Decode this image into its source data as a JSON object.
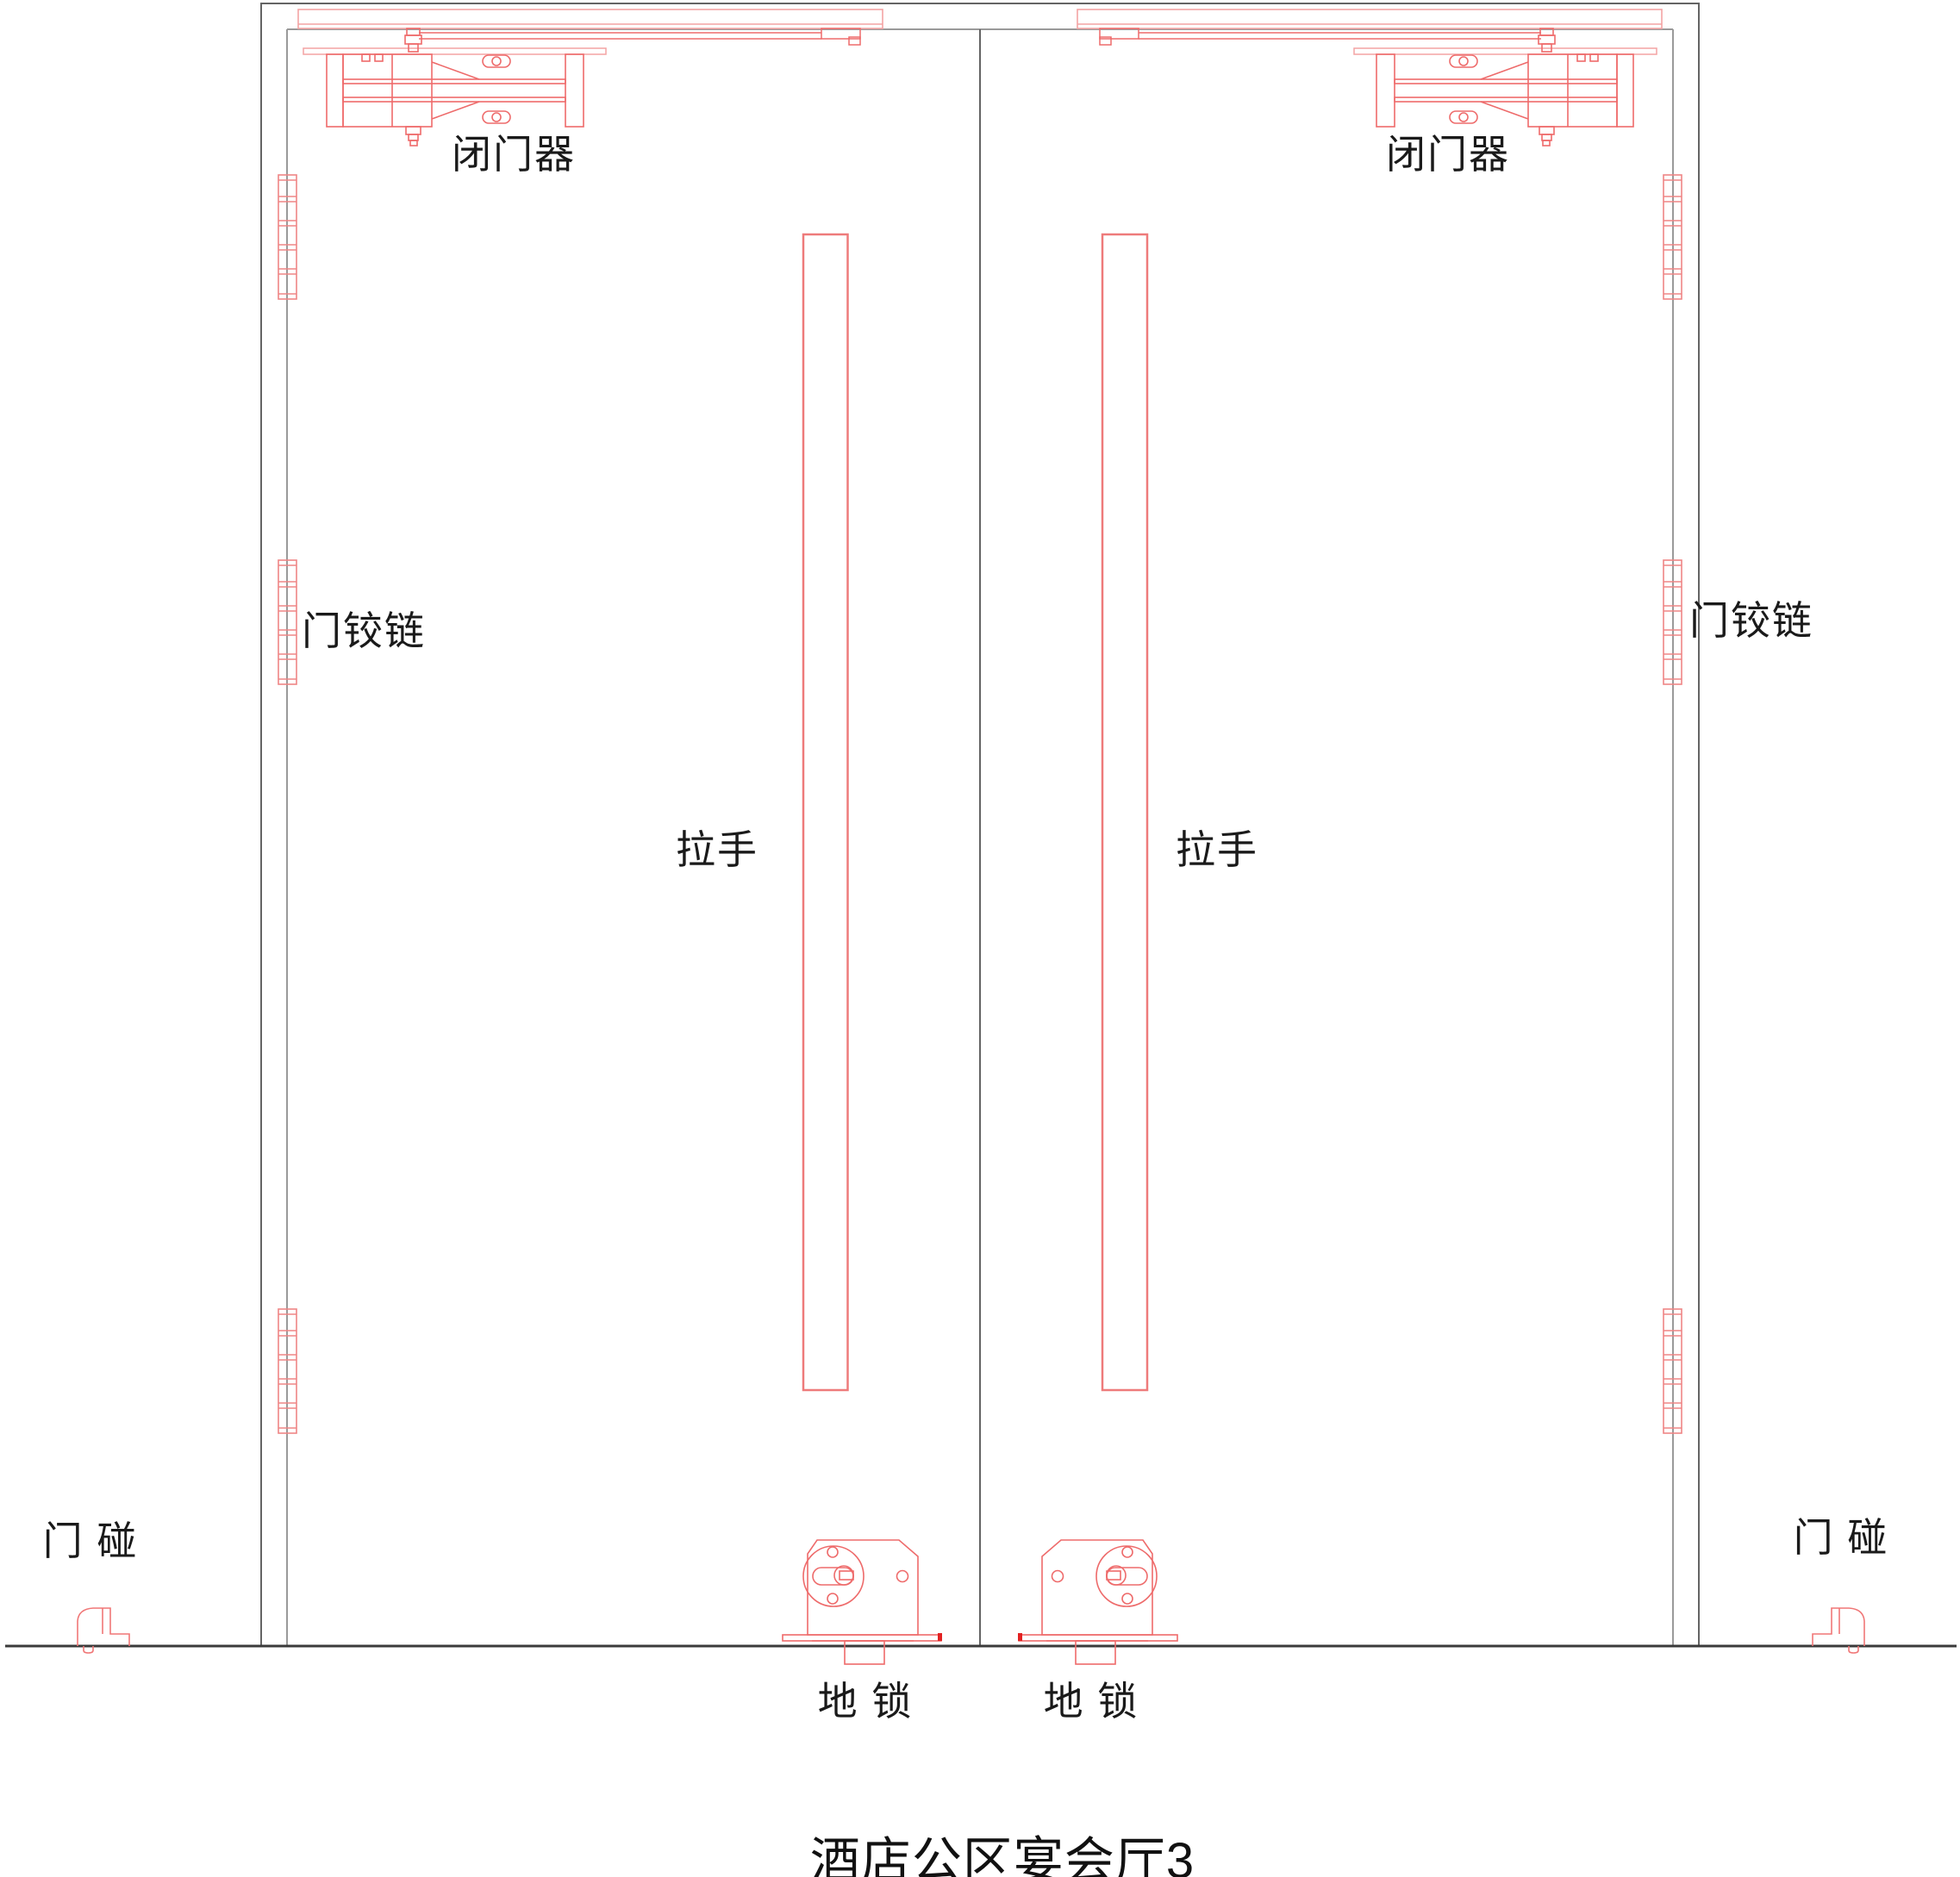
{
  "drawing": {
    "title": "酒店公区宴会厅3",
    "labels": {
      "door_closer_left": "闭门器",
      "door_closer_right": "闭门器",
      "hinge_left": "门铰链",
      "hinge_right": "门铰链",
      "handle_left": "拉手",
      "handle_right": "拉手",
      "floor_lock_left": "地 锁",
      "floor_lock_right": "地 锁",
      "door_stop_left": "门 碰",
      "door_stop_right": "门 碰"
    },
    "colors": {
      "hardware_red": "#ee6b6b",
      "hardware_light_red": "#f4a3a3",
      "handle_red": "#ee7b7b",
      "accent_fill_red": "#e32222",
      "frame_gray": "#646464",
      "leaf_gray": "#9a9a9a",
      "floor_dark": "#3a3a3a",
      "text_black": "#1a1a1a"
    }
  }
}
